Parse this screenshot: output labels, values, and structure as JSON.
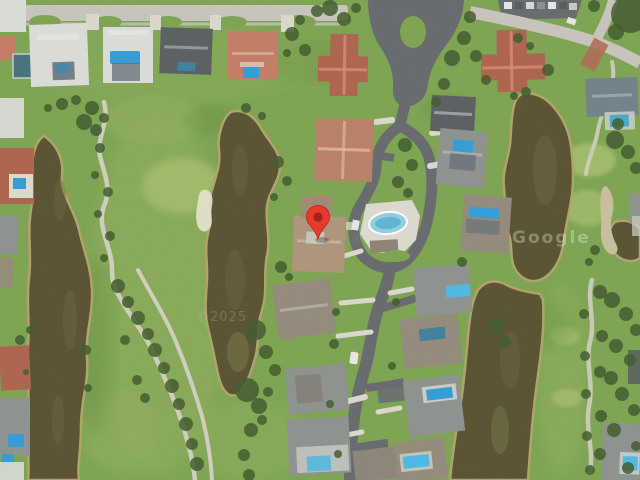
{
  "map": {
    "view_type": "satellite-imagery",
    "watermarks": [
      {
        "text": "Google",
        "x": 512,
        "y": 243,
        "opacity": 0.3
      },
      {
        "text": "©2025",
        "x": 196,
        "y": 321,
        "opacity": 0.17
      }
    ],
    "marker": {
      "icon": "map-pin",
      "x": 318,
      "y": 239,
      "transform": "translate(318,239)"
    },
    "palette": {
      "grass": "#7ba34f",
      "grass_light": "#90b05c",
      "grass_bright": "#a7c16d",
      "grass_dark": "#688f41",
      "water": "#564f2e",
      "water_edge": "#b1a268",
      "water_streak": "#6b6140",
      "algae": "#7d7c48",
      "road": "#64686c",
      "concrete": "#c7c5be",
      "path": "#d2cfc1",
      "path_tan": "#cbbf9b",
      "drive": "#dcd9d0",
      "deck": "#dedbd2",
      "roof_white": "#dcdedb",
      "roof_gray": "#8d918f",
      "roof_dark": "#575c5f",
      "roof_brown": "#92897b",
      "roof_tan": "#ad947a",
      "roof_salmon": "#c57a64",
      "roof_terra": "#ae614b",
      "roof_slate": "#6e8089",
      "pool": "#2f9cd8",
      "pool_bright": "#49b9e8",
      "pool_dark": "#3a7f9d",
      "pool_pale": "#8ed0e4",
      "cage": "#5d6b74",
      "tree": "#3d5829",
      "brick": "#ad6a52",
      "car_light": "#e8e8e5",
      "car_dark": "#54585c",
      "marker": "#e8392c",
      "marker_dark": "#9c261c",
      "watermark": "#ffffff"
    }
  }
}
